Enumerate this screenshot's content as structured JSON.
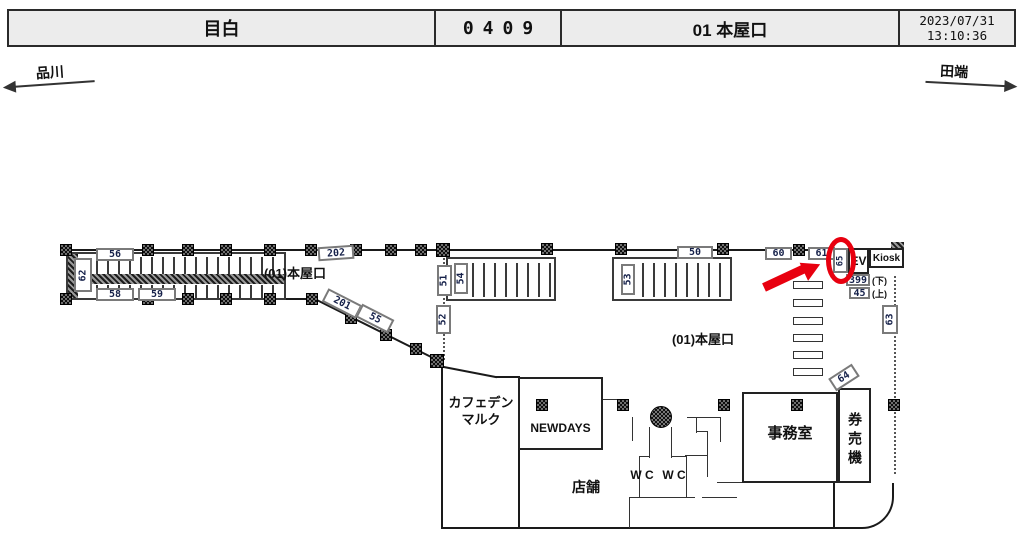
{
  "header": {
    "station_name": "目白",
    "station_code": "0409",
    "location": "01 本屋口",
    "date": "2023/07/31",
    "time": "13:10:36"
  },
  "nav": {
    "left_station": "品川",
    "right_station": "田端"
  },
  "plan": {
    "area_labels": {
      "corridor": "(01)本屋口",
      "concourse": "(01)本屋口"
    },
    "cameras": {
      "c45": "45",
      "c50": "50",
      "c51": "51",
      "c52": "52",
      "c53": "53",
      "c54": "54",
      "c55": "55",
      "c56": "56",
      "c58": "58",
      "c59": "59",
      "c60": "60",
      "c61": "61",
      "c62": "62",
      "c63": "63",
      "c64": "64",
      "c65": "65",
      "c201": "201",
      "c202": "202",
      "c399": "399"
    },
    "notes": {
      "down": "(下)",
      "up": "(上)"
    },
    "facilities": {
      "ev": "EV",
      "kiosk": "Kiosk",
      "cafe_line1": "カフェデン",
      "cafe_line2": "マルク",
      "newdays": "NEWDAYS",
      "shop": "店舗",
      "wc_left": "W C",
      "wc_right": "W C",
      "office": "事務室",
      "ticket_machine": "券売機"
    }
  },
  "annotation": {
    "highlight_color": "#e8000f"
  }
}
